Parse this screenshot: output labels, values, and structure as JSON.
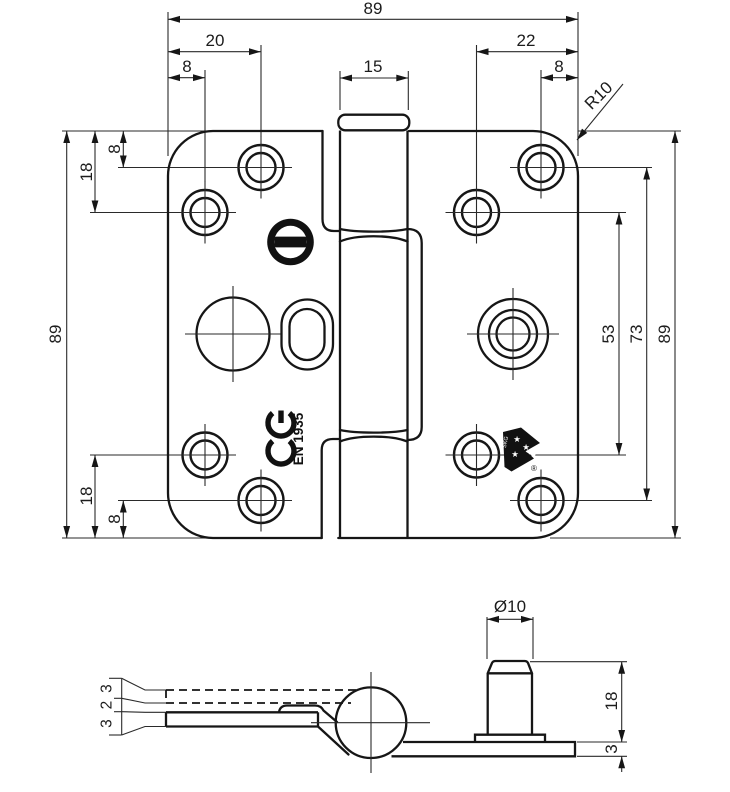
{
  "top_view": {
    "width_total": "89",
    "hole_offset_left_outer": "20",
    "hole_offset_left_inner": "8",
    "knuckle_width": "15",
    "hole_offset_right_outer": "22",
    "hole_offset_right_inner": "8",
    "corner_radius": "R10",
    "row_offset_top_first": "8",
    "row_offset_top_second": "18",
    "height_total_left": "89",
    "row_offset_bottom_second": "18",
    "row_offset_bottom_first": "8",
    "hole_span_inner": "53",
    "hole_span_outer": "73",
    "height_total_right": "89",
    "ce_mark": "CE",
    "standard_code": "EN 1935",
    "certification": "SKG",
    "registered_symbol": "®"
  },
  "side_view": {
    "upper_leaf_thickness": "3",
    "leaf_gap": "2",
    "lower_leaf_thickness": "3",
    "stud_diameter": "Ø10",
    "stud_height": "18",
    "plate_thickness": "3"
  }
}
